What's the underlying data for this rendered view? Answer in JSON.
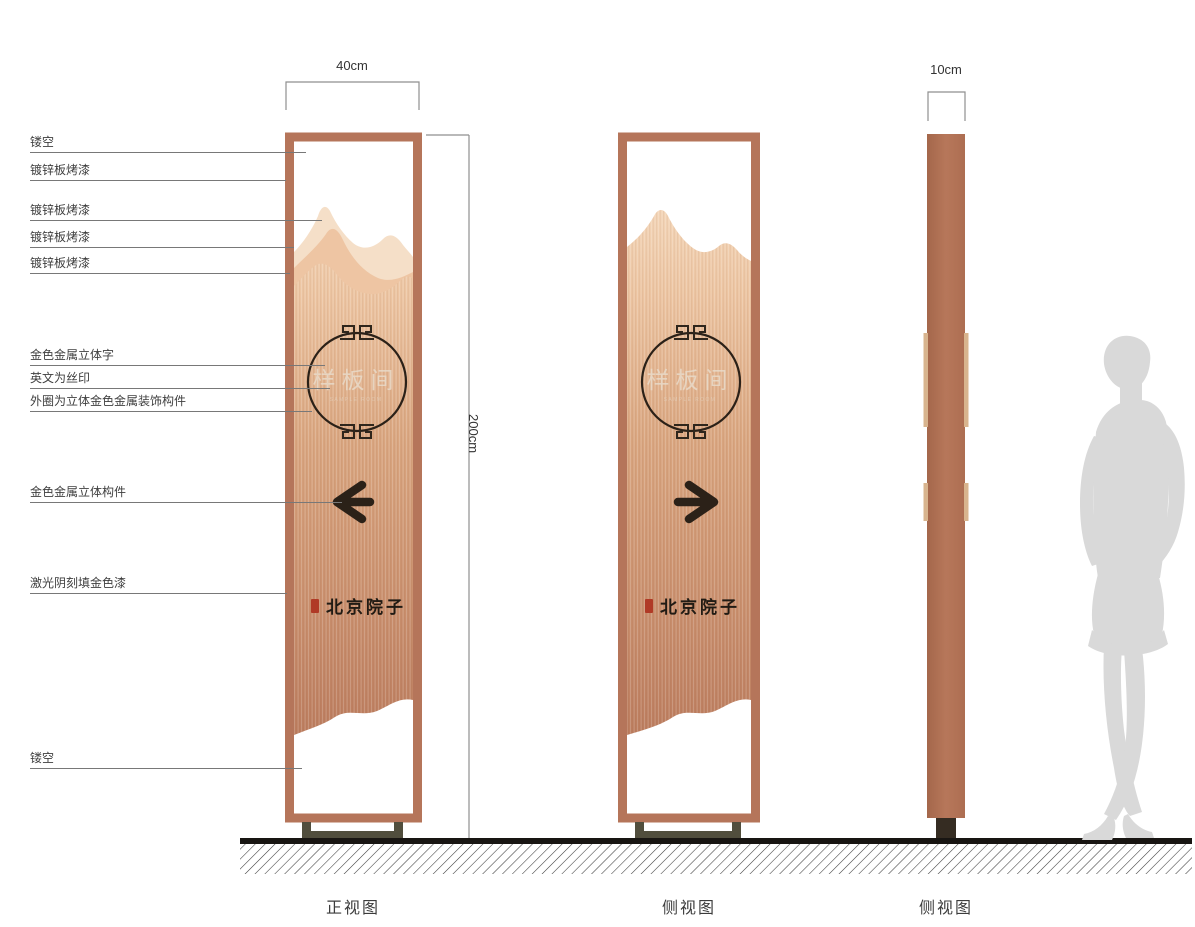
{
  "drawing": {
    "annotations": [
      "镂空",
      "镀锌板烤漆",
      "镀锌板烤漆",
      "镀锌板烤漆",
      "镀锌板烤漆",
      "金色金属立体字",
      "英文为丝印",
      "外圈为立体金色金属装饰构件",
      "金色金属立体构件",
      "激光阴刻填金色漆",
      "镂空"
    ],
    "dimensions": {
      "front_width": "40cm",
      "height": "200cm",
      "side_width": "10cm"
    },
    "sign": {
      "room_name": "样板间",
      "room_name_en": "SAMPLE ROOM",
      "brand_logo": "北京院子"
    },
    "views": [
      "正视图",
      "侧视图",
      "侧视图"
    ],
    "icons": {
      "front_arrow": "arrow-left",
      "side_arrow": "arrow-right"
    },
    "colors": {
      "frame": "#b5755a",
      "panel_top": "#f4d7ba",
      "panel_bottom": "#bb7c5e",
      "mountain_light": "#f5dfc8",
      "mountain_mid": "#eec5a3",
      "dark": "#2b2118",
      "ring_text": "#e9ddcd",
      "seal_red": "#b03a26",
      "base": "#514e3d",
      "profile_foot": "#352c22",
      "strip": "#d8b48e",
      "ground": "#181512",
      "silhouette": "#d9d9d9"
    }
  }
}
